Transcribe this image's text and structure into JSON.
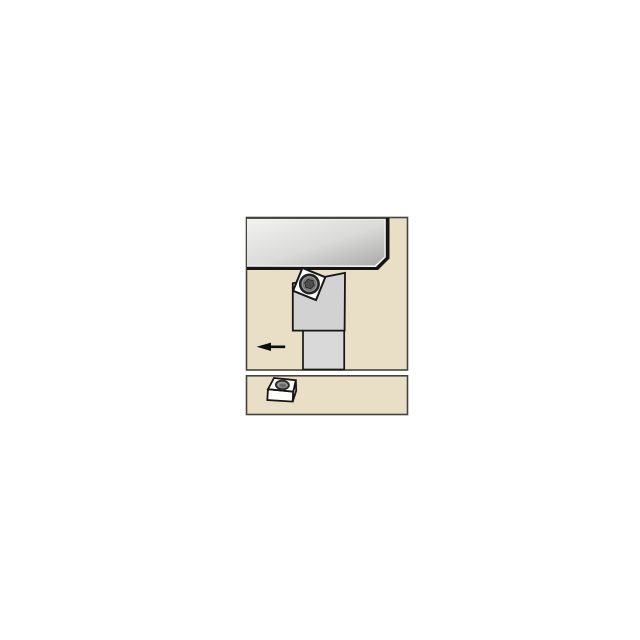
{
  "diagram": {
    "kind": "tool-application-illustration",
    "canvas": {
      "width": 640,
      "height": 640,
      "background": "#ffffff"
    }
  },
  "colors": {
    "panel_fill": "#e9dec6",
    "panel_border": "#45443c",
    "outline_black": "#161616",
    "workpiece_border": "#151515",
    "workpiece_highlight": "#f5f4f1",
    "holder_head_fill": "#d2d2d2",
    "holder_shank_fill": "#d9d9d9",
    "insert_fill": "#fcfcfa",
    "screw_fill": "#9b9b9b",
    "screw_ring": "#717171",
    "screw_socket_fill": "#4e4e4e",
    "arrow_black": "#0d0d0d",
    "icon_face_white": "#fdfdfc",
    "icon_side_white": "#efefec",
    "hole_fill": "#949494",
    "hole_inner": "#6b6b6b",
    "hole_stroke": "#2b2b2b"
  },
  "gradients": [
    {
      "id": "workpieceGrad",
      "x1": "0",
      "y1": "0",
      "x2": "1",
      "y2": "1",
      "stops": [
        {
          "offset": "0%",
          "color": "#f2f2f1"
        },
        {
          "offset": "55%",
          "color": "#dadad9"
        },
        {
          "offset": "100%",
          "color": "#a9a9a9"
        }
      ]
    }
  ],
  "scene": {
    "shapes": [
      {
        "type": "rect",
        "name": "upper-panel",
        "x": 246.5,
        "y": 217.5,
        "w": 161,
        "h": 152.5,
        "fill": "$panel_fill",
        "stroke": "$panel_border",
        "sw": 1.6
      },
      {
        "type": "polygon",
        "name": "workpiece-border",
        "points": [
          [
            247,
            218
          ],
          [
            389.5,
            218
          ],
          [
            389.5,
            258.5
          ],
          [
            378,
            270
          ],
          [
            247,
            270
          ]
        ],
        "fill": "$workpiece_border"
      },
      {
        "type": "polygon",
        "name": "workpiece-highlight-edge",
        "points": [
          [
            247,
            218.8
          ],
          [
            385.8,
            218.8
          ],
          [
            385.8,
            257.2
          ],
          [
            375.9,
            267
          ],
          [
            247,
            266.8
          ]
        ],
        "fill": "$workpiece_highlight"
      },
      {
        "type": "polygon",
        "name": "workpiece-face",
        "points": [
          [
            247,
            219.6
          ],
          [
            384.4,
            219.6
          ],
          [
            384.4,
            256.6
          ],
          [
            375,
            265.4
          ],
          [
            247,
            265.4
          ]
        ],
        "fill": "url(#workpieceGrad)"
      },
      {
        "type": "rect",
        "name": "tool-shank",
        "x": 303,
        "y": 330.5,
        "w": 41.2,
        "h": 39,
        "fill": "$holder_shank_fill",
        "stroke": "$outline_black",
        "sw": 1.7
      },
      {
        "type": "polygon",
        "name": "tool-head",
        "points": [
          [
            292.8,
            283.3
          ],
          [
            345,
            272.9
          ],
          [
            344.6,
            330.6
          ],
          [
            292.8,
            330.6
          ]
        ],
        "fill": "$holder_head_fill",
        "stroke": "$outline_black",
        "sw": 1.8
      },
      {
        "type": "polygon",
        "name": "indexable-insert",
        "points": [
          [
            302.4,
            267.9
          ],
          [
            325.3,
            277.2
          ],
          [
            316,
            300.1
          ],
          [
            293.1,
            290.8
          ]
        ],
        "fill": "$insert_fill",
        "stroke": "$outline_black",
        "sw": 2
      },
      {
        "type": "circle",
        "name": "insert-screw",
        "cx": 309.4,
        "cy": 284,
        "r": 9.2,
        "fill": "$screw_fill",
        "stroke": "#242424",
        "sw": 2.6
      },
      {
        "type": "circle",
        "name": "insert-screw-ring",
        "cx": 309.4,
        "cy": 284,
        "r": 6,
        "fill": "none",
        "stroke": "$screw_ring",
        "sw": 1.4
      },
      {
        "type": "polygon",
        "name": "insert-screw-socket",
        "points": [
          [
            314.13,
            285.27
          ],
          [
            310.67,
            288.73
          ],
          [
            305.94,
            287.46
          ],
          [
            304.67,
            282.73
          ],
          [
            308.13,
            279.27
          ],
          [
            312.86,
            280.54
          ]
        ],
        "fill": "$screw_socket_fill",
        "stroke": "#2a2a2a",
        "sw": 1
      },
      {
        "type": "polygon",
        "name": "feed-direction-arrow",
        "points": [
          [
            256.6,
            346.8
          ],
          [
            271,
            342.6
          ],
          [
            271,
            345.5
          ],
          [
            285.2,
            345.5
          ],
          [
            285.2,
            348.1
          ],
          [
            271,
            348.1
          ],
          [
            271,
            351
          ]
        ],
        "fill": "$arrow_black"
      },
      {
        "type": "rect",
        "name": "lower-panel",
        "x": 246.5,
        "y": 375.8,
        "w": 161,
        "h": 38.7,
        "fill": "$panel_fill",
        "stroke": "$panel_border",
        "sw": 1.6
      },
      {
        "type": "polygon",
        "name": "insert-3d-front-face",
        "points": [
          [
            268,
            389.2
          ],
          [
            293.3,
            391.6
          ],
          [
            292.7,
            401.6
          ],
          [
            267.3,
            400
          ]
        ],
        "fill": "$icon_face_white",
        "stroke": "$outline_black",
        "sw": 1.8
      },
      {
        "type": "polygon",
        "name": "insert-3d-right-face",
        "points": [
          [
            295.8,
            380.2
          ],
          [
            296.2,
            390.8
          ],
          [
            292.7,
            401.6
          ],
          [
            293.3,
            391.6
          ]
        ],
        "fill": "$icon_side_white",
        "stroke": "$outline_black",
        "sw": 1.8
      },
      {
        "type": "polygon",
        "name": "insert-3d-top-face",
        "points": [
          [
            274,
            378
          ],
          [
            295.8,
            380.2
          ],
          [
            293.3,
            391.6
          ],
          [
            268,
            389.2
          ]
        ],
        "fill": "$icon_face_white",
        "stroke": "$outline_black",
        "sw": 1.8
      },
      {
        "type": "ellipse",
        "name": "insert-3d-hole",
        "cx": 282.4,
        "cy": 385,
        "rx": 6.5,
        "ry": 4.3,
        "rotate": 4,
        "fill": "$hole_fill",
        "stroke": "$hole_stroke",
        "sw": 1.9
      },
      {
        "type": "ellipse",
        "name": "insert-3d-hole-inner",
        "cx": 282.7,
        "cy": 385.6,
        "rx": 3.4,
        "ry": 2.1,
        "rotate": 4,
        "fill": "$hole_inner"
      }
    ]
  }
}
